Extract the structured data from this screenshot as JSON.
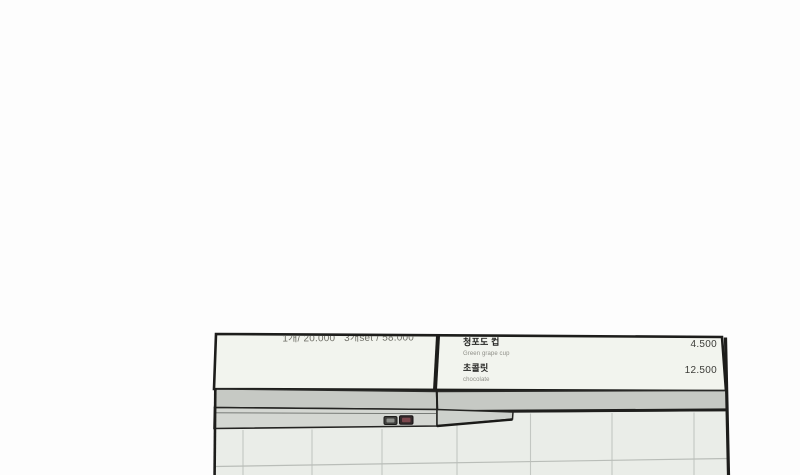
{
  "scene_description": "photo-style render of a cafe wall: two menu boards above a gray shelf hood with two small switches, white tiled wall below",
  "menu_board": {
    "left_panel": {
      "price_line": "1개/ 20.000   3개set / 58.000"
    },
    "right_panel": {
      "items": [
        {
          "name": "청포도 컵",
          "subtitle": "Green grape cup",
          "price": "4.500"
        },
        {
          "name": "초콜릿",
          "subtitle": "chocolate",
          "price": "12.500"
        }
      ]
    }
  },
  "colors": {
    "page_background": "#fdfdfd",
    "panel_fill": "#f2f4ee",
    "band_gray": "#c6c9c4",
    "hood_gray": "#d4d7d2",
    "cap_gray": "#cdd1cc",
    "tile_fill": "#eaede8",
    "grout": "#c3c7c2",
    "outline": "#1d1d1b",
    "price_line_text": "#6e6e66",
    "item_name_text": "#232321",
    "item_subtitle_text": "#8e8e87",
    "item_price_text": "#3c3c38",
    "switch_left_inner": "#8e908b",
    "switch_right_inner": "#7c474d"
  }
}
